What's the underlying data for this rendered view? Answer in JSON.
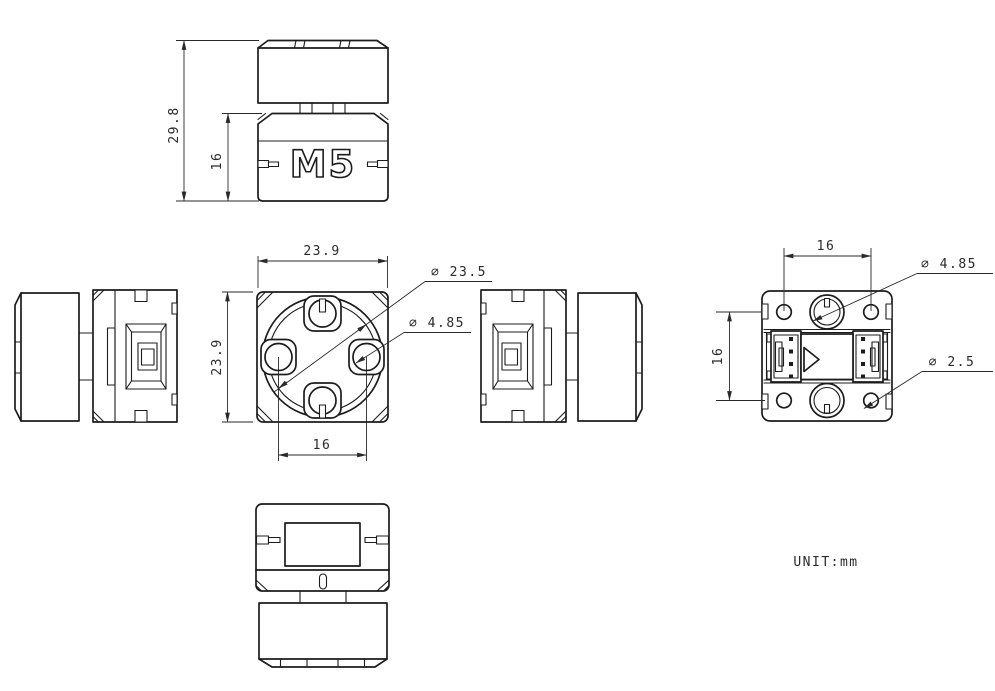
{
  "logo": "M5",
  "unit_label": "UNIT:mm",
  "dims": {
    "side_total_height": "29.8",
    "side_body_height": "16",
    "front_width": "23.9",
    "front_height": "23.9",
    "front_hole_spacing": "16",
    "front_lens_dia": "∅ 23.5",
    "front_hole_dia": "∅ 4.85",
    "back_hole_spacing_h": "16",
    "back_hole_spacing_v": "16",
    "back_hole_dia": "∅ 4.85",
    "back_screw_dia": "∅ 2.5"
  }
}
